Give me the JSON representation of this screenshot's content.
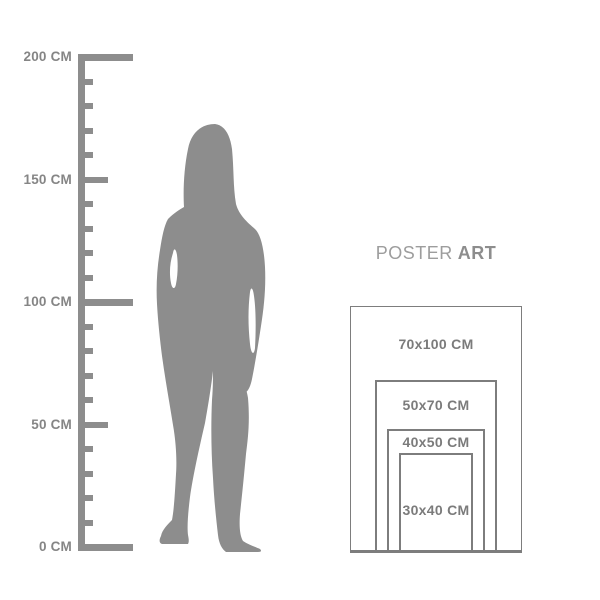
{
  "ruler": {
    "unit": "CM",
    "min_cm": 0,
    "max_cm": 200,
    "tick_step_cm": 10,
    "labels": [
      {
        "value": 200,
        "label": "200 CM"
      },
      {
        "value": 150,
        "label": "150 CM"
      },
      {
        "value": 100,
        "label": "100 CM"
      },
      {
        "value": 50,
        "label": "50 CM"
      },
      {
        "value": 0,
        "label": "0 CM"
      }
    ],
    "color": "#8d8d8d",
    "label_color": "#858585"
  },
  "figure": {
    "color": "#8d8d8d"
  },
  "poster_guide": {
    "title": {
      "regular": "POSTER",
      "bold": "ART"
    },
    "title_regular_color": "#9d9d9d",
    "title_bold_color": "#8d8d8d",
    "border_color": "#7d7d7d",
    "label_color": "#7b7b7b",
    "sizes": [
      {
        "label": "70x100 CM",
        "width_cm": 70,
        "height_cm": 100
      },
      {
        "label": "50x70 CM",
        "width_cm": 50,
        "height_cm": 70
      },
      {
        "label": "40x50 CM",
        "width_cm": 40,
        "height_cm": 50
      },
      {
        "label": "30x40 CM",
        "width_cm": 30,
        "height_cm": 40
      }
    ]
  }
}
